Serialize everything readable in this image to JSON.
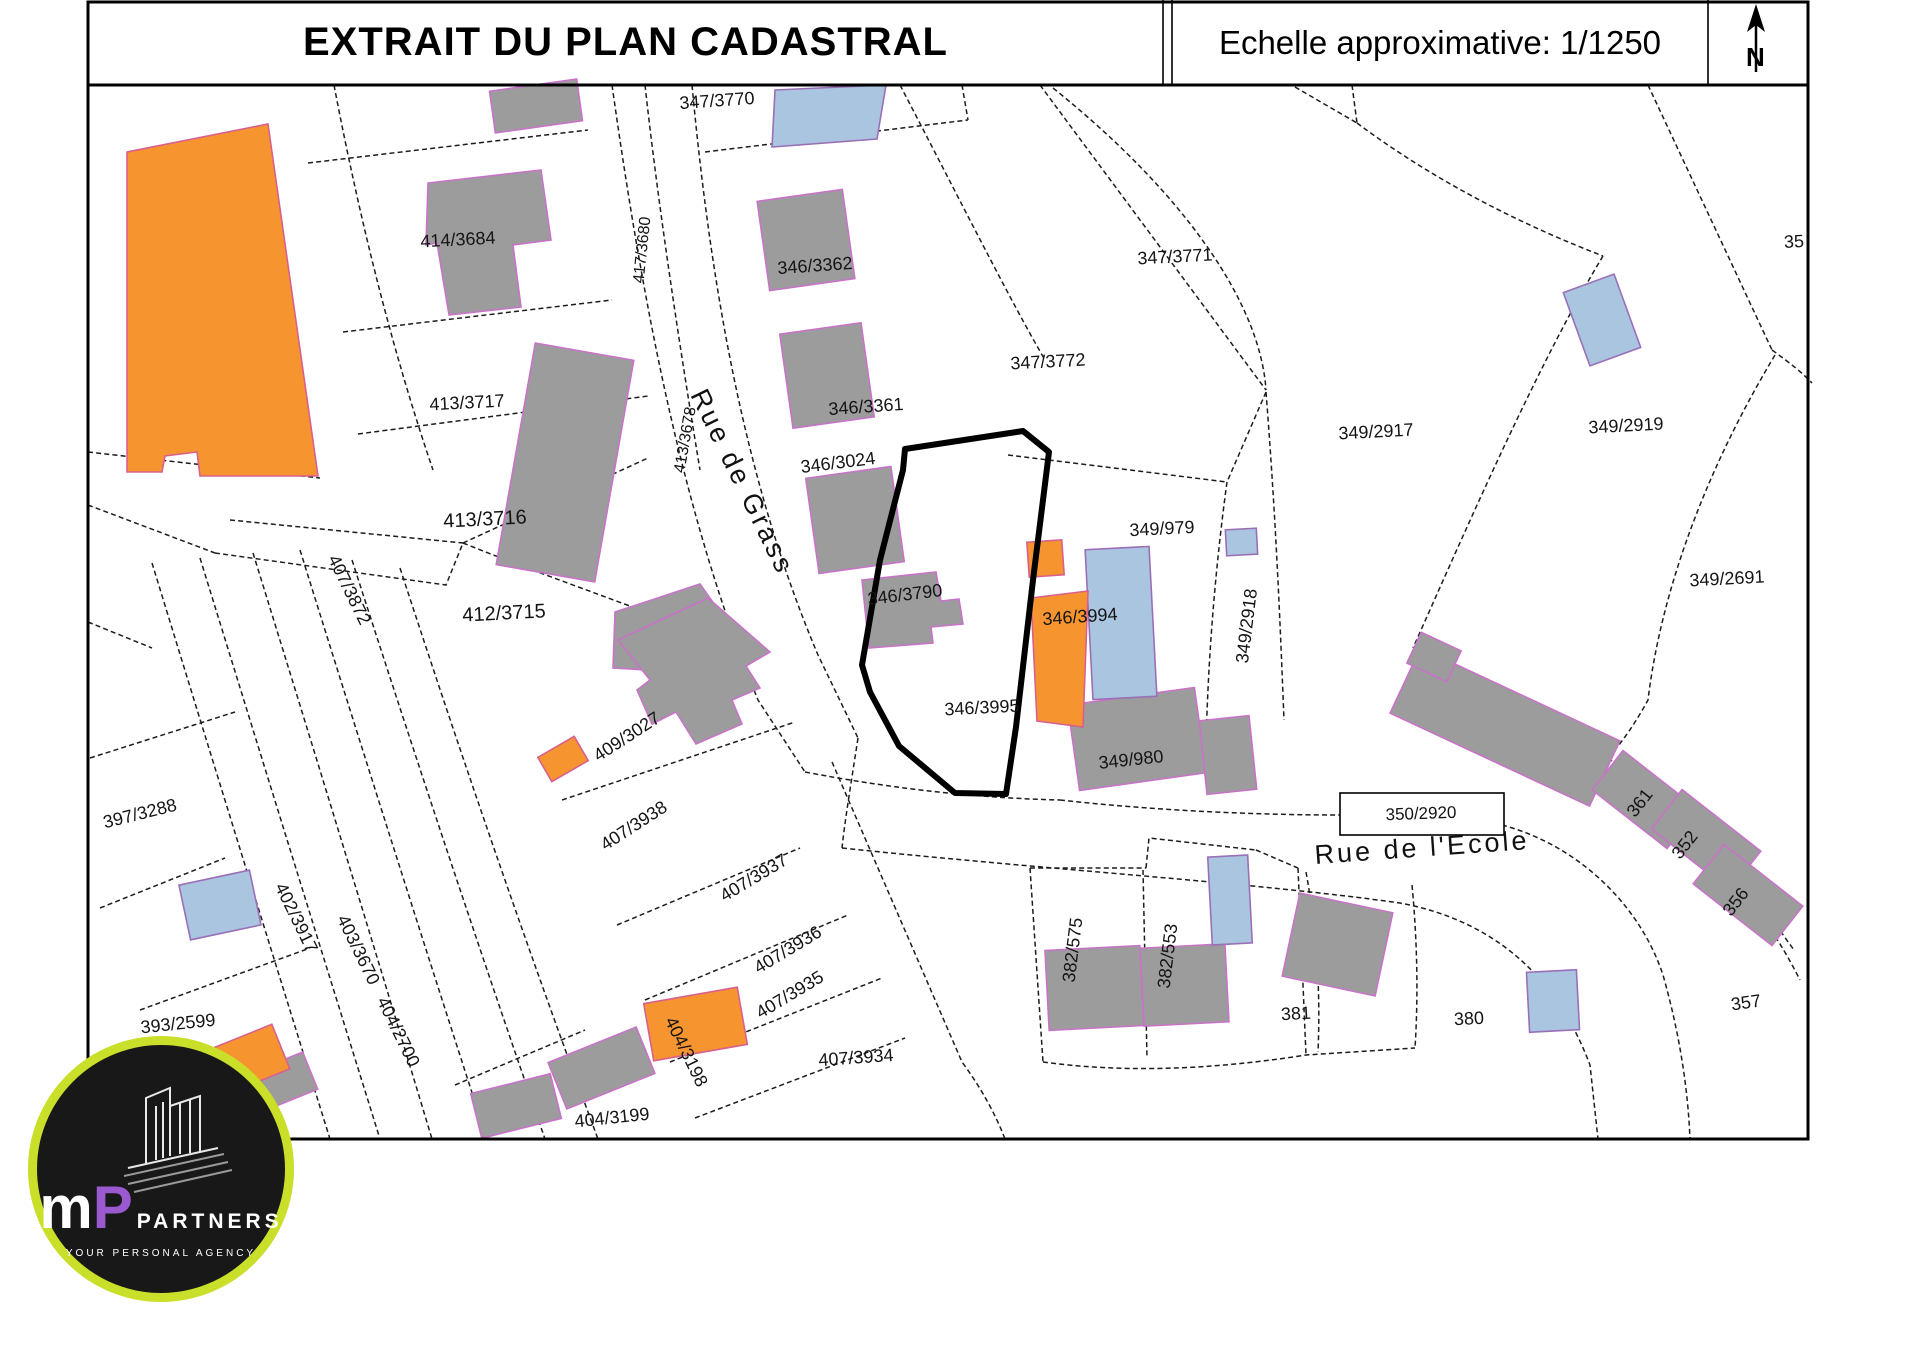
{
  "header": {
    "title": "EXTRAIT DU PLAN CADASTRAL",
    "scale_label": "Echelle approximative: 1/1250",
    "north_letter": "N"
  },
  "colors": {
    "building_gray": "#9c9c9c",
    "building_blue": "#a9c5df",
    "building_orange": "#f6952f",
    "building_outline": "#c873c8",
    "logo_ring": "#c9df2a",
    "logo_p": "#9b59d0"
  },
  "map": {
    "streets": [
      {
        "name": "Rue de Grass",
        "x": 742,
        "y": 482,
        "r": 64,
        "s": 27
      },
      {
        "name": "Rue de l'Ecole",
        "x": 1422,
        "y": 848,
        "r": -4,
        "s": 27
      }
    ],
    "selected_parcel": {
      "label": "346/3995",
      "pts": "905,449 1023,431 1049,452 1033,580 1016,727 1006,794 955,793 899,746 870,692 862,665 880,560 903,470"
    },
    "parcels": [
      {
        "l": "414/3684",
        "x": 458,
        "y": 240,
        "r": -3
      },
      {
        "l": "413/3717",
        "x": 467,
        "y": 403,
        "r": -3
      },
      {
        "l": "413/3716",
        "x": 485,
        "y": 520,
        "r": -3,
        "s": 20
      },
      {
        "l": "412/3715",
        "x": 504,
        "y": 614,
        "r": -3,
        "s": 20
      },
      {
        "l": "407/3872",
        "x": 349,
        "y": 590,
        "r": 64
      },
      {
        "l": "397/3288",
        "x": 140,
        "y": 814,
        "r": -14
      },
      {
        "l": "393/2599",
        "x": 178,
        "y": 1024,
        "r": -6
      },
      {
        "l": "402/3917",
        "x": 296,
        "y": 918,
        "r": 64
      },
      {
        "l": "403/3670",
        "x": 358,
        "y": 950,
        "r": 64
      },
      {
        "l": "404/2700",
        "x": 398,
        "y": 1032,
        "r": 64
      },
      {
        "l": "404/3198",
        "x": 686,
        "y": 1052,
        "r": 64
      },
      {
        "l": "404/3199",
        "x": 612,
        "y": 1118,
        "r": -6
      },
      {
        "l": "407/3938",
        "x": 634,
        "y": 826,
        "r": -33
      },
      {
        "l": "407/3937",
        "x": 754,
        "y": 878,
        "r": -31
      },
      {
        "l": "407/3936",
        "x": 788,
        "y": 950,
        "r": -31
      },
      {
        "l": "407/3935",
        "x": 790,
        "y": 995,
        "r": -31
      },
      {
        "l": "407/3934",
        "x": 856,
        "y": 1058,
        "r": -4
      },
      {
        "l": "409/3027",
        "x": 627,
        "y": 737,
        "r": -33
      },
      {
        "l": "347/3770",
        "x": 717,
        "y": 101,
        "r": -4
      },
      {
        "l": "346/3362",
        "x": 815,
        "y": 266,
        "r": -4
      },
      {
        "l": "346/3361",
        "x": 866,
        "y": 407,
        "r": -4
      },
      {
        "l": "346/3024",
        "x": 838,
        "y": 463,
        "r": -7
      },
      {
        "l": "346/3790",
        "x": 905,
        "y": 595,
        "r": -7
      },
      {
        "l": "346/3995",
        "x": 982,
        "y": 708,
        "r": -3
      },
      {
        "l": "346/3994",
        "x": 1080,
        "y": 617,
        "r": -4
      },
      {
        "l": "347/3771",
        "x": 1175,
        "y": 257,
        "r": -3
      },
      {
        "l": "347/3772",
        "x": 1048,
        "y": 362,
        "r": -3
      },
      {
        "l": "349/979",
        "x": 1162,
        "y": 529,
        "r": -3
      },
      {
        "l": "349/2917",
        "x": 1376,
        "y": 432,
        "r": -3
      },
      {
        "l": "349/2919",
        "x": 1626,
        "y": 426,
        "r": -3
      },
      {
        "l": "349/2691",
        "x": 1727,
        "y": 579,
        "r": -3
      },
      {
        "l": "349/2918",
        "x": 1247,
        "y": 626,
        "r": -83
      },
      {
        "l": "349/980",
        "x": 1131,
        "y": 760,
        "r": -6
      },
      {
        "l": "350/2920",
        "x": 1421,
        "y": 814,
        "r": -2,
        "s": 17
      },
      {
        "l": "382/575",
        "x": 1073,
        "y": 950,
        "r": -83
      },
      {
        "l": "382/553",
        "x": 1168,
        "y": 956,
        "r": -83
      },
      {
        "l": "381",
        "x": 1296,
        "y": 1014,
        "r": -3
      },
      {
        "l": "380",
        "x": 1469,
        "y": 1019,
        "r": -3
      },
      {
        "l": "361",
        "x": 1640,
        "y": 803,
        "r": -52
      },
      {
        "l": "352",
        "x": 1685,
        "y": 845,
        "r": -52
      },
      {
        "l": "356",
        "x": 1736,
        "y": 902,
        "r": -52
      },
      {
        "l": "357",
        "x": 1746,
        "y": 1003,
        "r": -8
      },
      {
        "l": "417/3680",
        "x": 643,
        "y": 250,
        "r": -84,
        "s": 16
      },
      {
        "l": "413/3678",
        "x": 686,
        "y": 440,
        "r": -80,
        "s": 16
      },
      {
        "l": "35",
        "x": 1794,
        "y": 242,
        "r": -3
      }
    ],
    "buildings": [
      {
        "c": "gray",
        "pts": "428,183 541,170 551,240 513,245 521,307 449,315 437,243 426,245"
      },
      {
        "c": "gray",
        "x": 515,
        "y": 350,
        "w": 100,
        "h": 225,
        "r": 10
      },
      {
        "c": "gray",
        "pts": "615,612 700,584 748,652 724,662 737,682 660,706 647,670 613,668"
      },
      {
        "c": "gray",
        "x": 763,
        "y": 195,
        "w": 86,
        "h": 90,
        "r": -8
      },
      {
        "c": "gray",
        "x": 786,
        "y": 328,
        "w": 82,
        "h": 95,
        "r": -8
      },
      {
        "c": "gray",
        "x": 812,
        "y": 472,
        "w": 86,
        "h": 96,
        "r": -8
      },
      {
        "c": "gray",
        "pts": "862,580 936,572 941,601 959,599 963,624 931,627 933,643 869,648"
      },
      {
        "c": "gray",
        "x": 1073,
        "y": 696,
        "w": 128,
        "h": 86,
        "r": -8
      },
      {
        "c": "gray",
        "x": 1203,
        "y": 718,
        "w": 50,
        "h": 74,
        "r": -6
      },
      {
        "c": "gray",
        "x": 1395,
        "y": 691,
        "w": 220,
        "h": 72,
        "r": 25
      },
      {
        "c": "gray",
        "x": 1412,
        "y": 640,
        "w": 44,
        "h": 34,
        "r": 25
      },
      {
        "c": "gray",
        "x": 1620,
        "y": 752,
        "w": 50,
        "h": 95,
        "r": -52
      },
      {
        "c": "gray",
        "x": 1681,
        "y": 790,
        "w": 50,
        "h": 100,
        "r": -52
      },
      {
        "c": "gray",
        "x": 1723,
        "y": 845,
        "w": 50,
        "h": 100,
        "r": -52
      },
      {
        "c": "gray",
        "x": 1047,
        "y": 948,
        "w": 95,
        "h": 80,
        "r": -3
      },
      {
        "c": "gray",
        "x": 1142,
        "y": 946,
        "w": 85,
        "h": 78,
        "r": -3
      },
      {
        "c": "gray",
        "x": 1290,
        "y": 902,
        "w": 95,
        "h": 85,
        "r": 12
      },
      {
        "c": "gray",
        "x": 492,
        "y": 85,
        "w": 88,
        "h": 42,
        "r": -8
      },
      {
        "c": "gray",
        "x": 554,
        "y": 1043,
        "w": 95,
        "h": 50,
        "r": -22
      },
      {
        "c": "gray",
        "x": 475,
        "y": 1083,
        "w": 82,
        "h": 46,
        "r": -14
      },
      {
        "c": "gray",
        "pts": "618,640 708,598 770,652 746,666 760,688 732,700 742,724 696,744 676,712 652,724 637,690 650,680"
      },
      {
        "c": "gray",
        "x": 262,
        "y": 1060,
        "w": 50,
        "h": 40,
        "r": -22
      },
      {
        "c": "blue",
        "x": 1089,
        "y": 548,
        "w": 64,
        "h": 150,
        "r": -3
      },
      {
        "c": "blue",
        "x": 1226,
        "y": 529,
        "w": 31,
        "h": 26,
        "r": -3
      },
      {
        "c": "blue",
        "x": 1210,
        "y": 856,
        "w": 40,
        "h": 88,
        "r": -3
      },
      {
        "c": "blue",
        "x": 1528,
        "y": 971,
        "w": 50,
        "h": 60,
        "r": -3
      },
      {
        "c": "blue",
        "x": 1575,
        "y": 281,
        "w": 54,
        "h": 78,
        "r": -20
      },
      {
        "c": "blue",
        "pts": "775,90 886,85 877,139 772,147"
      },
      {
        "c": "blue",
        "x": 184,
        "y": 877,
        "w": 72,
        "h": 56,
        "r": -12
      },
      {
        "c": "orange",
        "pts": "127,152 268,124 318,476 200,476 197,452 165,456 162,472 127,472"
      },
      {
        "c": "orange",
        "x": 1028,
        "y": 541,
        "w": 35,
        "h": 35,
        "r": -4
      },
      {
        "c": "orange",
        "pts": "1031,598 1088,591 1083,727 1037,721"
      },
      {
        "c": "orange",
        "x": 196,
        "y": 1039,
        "w": 88,
        "h": 48,
        "r": -22
      },
      {
        "c": "orange",
        "x": 648,
        "y": 995,
        "w": 95,
        "h": 58,
        "r": -10
      },
      {
        "c": "orange",
        "x": 542,
        "y": 745,
        "w": 42,
        "h": 28,
        "r": -30
      }
    ]
  },
  "logo": {
    "letter_m": "m",
    "letter_p": "P",
    "brand": "PARTNERS",
    "tagline": "YOUR PERSONAL AGENCY"
  }
}
